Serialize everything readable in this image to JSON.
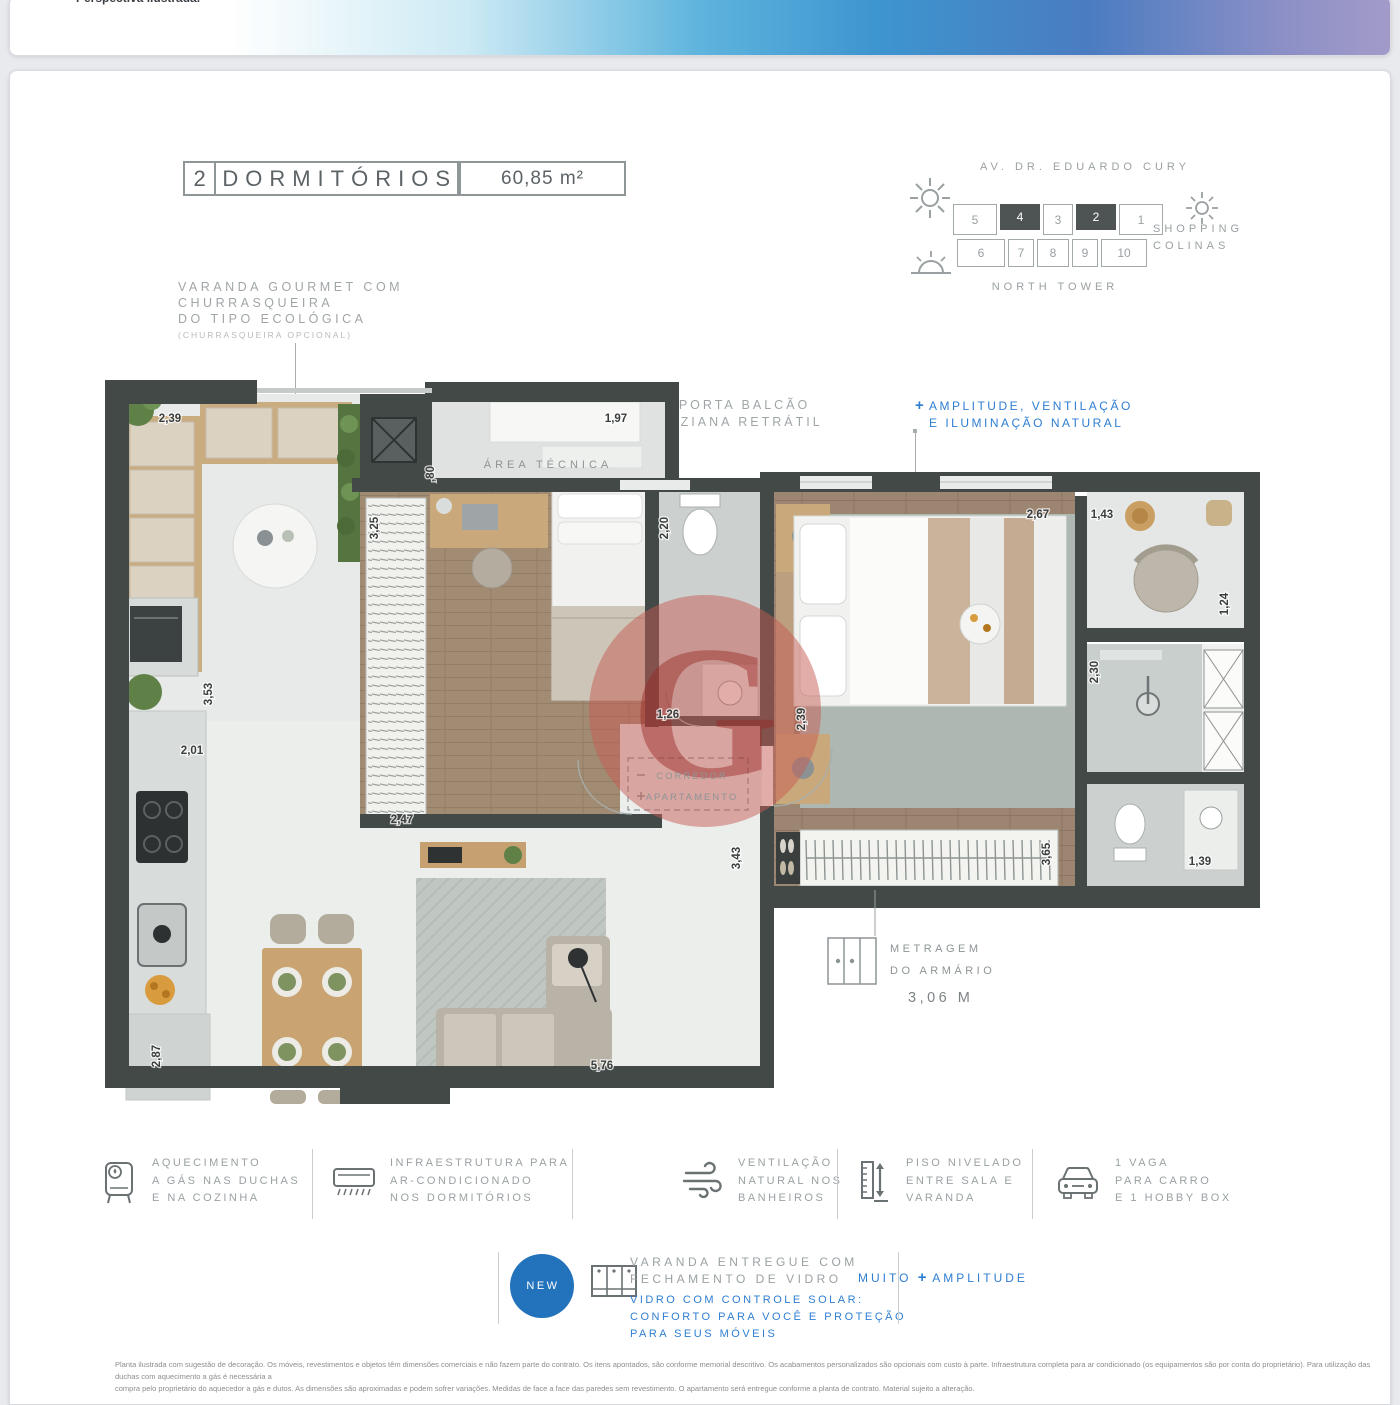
{
  "prev_card": {
    "note": "Perspectiva ilustrada."
  },
  "header": {
    "units_count": "2",
    "units_label": "DORMITÓRIOS",
    "area": "60,85 m²"
  },
  "varanda_note": {
    "line1": "VARANDA GOURMET COM",
    "line2": "CHURRASQUEIRA",
    "line3": "DO TIPO ECOLÓGICA",
    "line4": "(CHURRASQUEIRA OPCIONAL)"
  },
  "site": {
    "street": "AV. DR. EDUARDO CURY",
    "row1": [
      "5",
      "4",
      "3",
      "2",
      "1"
    ],
    "row2": [
      "6",
      "7",
      "8",
      "9",
      "10"
    ],
    "highlighted_units": [
      "4",
      "2"
    ],
    "shopping1": "SHOPPING",
    "shopping2": "COLINAS",
    "tower": "NORTH TOWER"
  },
  "window_note": {
    "gray1": "JANELA E PORTA BALCÃO",
    "gray2": "COM VENEZIANA RETRÁTIL",
    "plus": "+",
    "blue1": "AMPLITUDE, VENTILAÇÃO",
    "blue2": "E ILUMINAÇÃO NATURAL"
  },
  "plan": {
    "area_tecnica": "ÁREA TÉCNICA",
    "corredor_line1": "CORREDOR",
    "corredor_line2": "APARTAMENTO",
    "watermark_letter": "G",
    "dims": {
      "varanda_w": "2,39",
      "tecnica_w": "1,97",
      "tecnica_d": ",80",
      "dorm1_w": "3,25",
      "bath1_w": "2,20",
      "master_w": "2,67",
      "nook_w": "1,43",
      "nook_d": "1,24",
      "shower_d": "2,30",
      "kitchen_d": "3,53",
      "kitchen_w": "2,01",
      "hall_w": "1,26",
      "master_d": "2,39",
      "dorm1_d": "2,47",
      "living_d": "3,43",
      "closet_w": "3,65",
      "wc_w": "1,39",
      "kitchen_h": "2,87",
      "living_w": "5,76"
    },
    "closet_note": {
      "line1": "METRAGEM",
      "line2": "DO ARMÁRIO",
      "value": "3,06 M"
    }
  },
  "features": [
    {
      "icon": "water-heater-icon",
      "lines": [
        "AQUECIMENTO",
        "A GÁS NAS DUCHAS",
        "E NA COZINHA"
      ]
    },
    {
      "icon": "air-conditioner-icon",
      "lines": [
        "INFRAESTRUTURA PARA",
        "AR-CONDICIONADO",
        "NOS DORMITÓRIOS"
      ]
    },
    {
      "icon": "wind-icon",
      "lines": [
        "VENTILAÇÃO",
        "NATURAL NOS",
        "BANHEIROS"
      ]
    },
    {
      "icon": "level-ruler-icon",
      "lines": [
        "PISO NIVELADO",
        "ENTRE SALA E",
        "VARANDA"
      ],
      "highlight_left": "MUITO",
      "highlight_plus": "+",
      "highlight_right": "AMPLITUDE"
    },
    {
      "icon": "car-icon",
      "lines": [
        "1 VAGA",
        "PARA CARRO",
        "E 1 HOBBY BOX"
      ]
    }
  ],
  "new_section": {
    "badge": "NEW",
    "gray1": "VARANDA ENTREGUE COM",
    "gray2": "FECHAMENTO DE VIDRO",
    "blue1": "VIDRO COM CONTROLE SOLAR:",
    "blue2": "CONFORTO PARA VOCÊ E PROTEÇÃO",
    "blue3": "PARA SEUS MÓVEIS"
  },
  "disclaimer": {
    "line1": "Planta ilustrada com sugestão de decoração. Os móveis, revestimentos e objetos têm dimensões comerciais e não fazem parte do contrato. Os itens apontados, são conforme memorial descritivo. Os acabamentos personalizados são opcionais com custo à parte. Infraestrutura completa para ar condicionado (os equipamentos são por conta do proprietário). Para utilização das duchas com aquecimento a gás é necessária a",
    "line2": "compra pelo proprietário do aquecedor a gás e dutos. As dimensões são aproximadas e podem sofrer variações. Medidas de face a face das paredes sem revestimento. O apartamento será entregue conforme a planta de contrato. Material sujeito a alteração."
  },
  "colors": {
    "accent_blue": "#2e7ed2",
    "badge_blue": "#2273bb",
    "wall_dark": "#434947",
    "wood_floor": "#a28b73",
    "watermark_red": "#c05c54"
  }
}
